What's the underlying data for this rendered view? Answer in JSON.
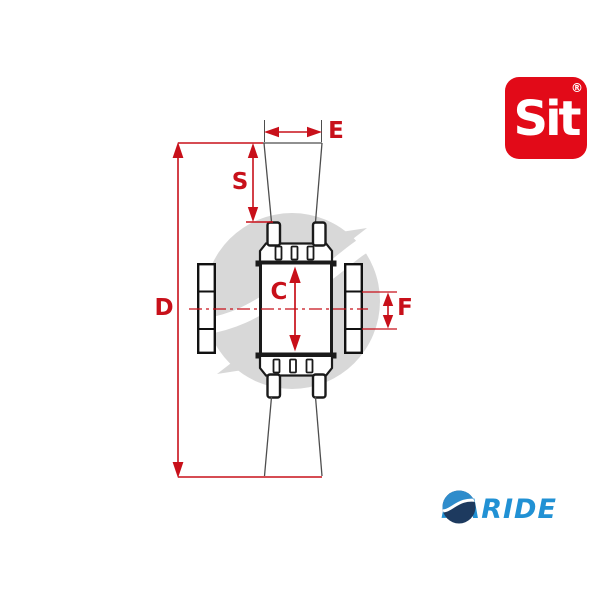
{
  "image": {
    "type": "technical-dimension-drawing",
    "subject": "universal joint cross kit with bearing cups",
    "background": "#ffffff"
  },
  "dimension_labels": {
    "D": "D",
    "S": "S",
    "E": "E",
    "C": "C",
    "F": "F"
  },
  "brand": {
    "sit": {
      "text": "Sit",
      "registered_mark": "®",
      "box_color": "#e20a18",
      "text_color": "#ffffff"
    },
    "paride": {
      "text": "PARIDE",
      "text_color": "#2191d4",
      "icon_blue": "#2f8ccb",
      "icon_navy": "#1d3a5f"
    }
  },
  "colors": {
    "dimension_red": "#c8101a",
    "part_outline": "#1a1a1a",
    "thin_line_gray": "#4d4d4d",
    "watermark_gray": "#d8d8d8"
  }
}
